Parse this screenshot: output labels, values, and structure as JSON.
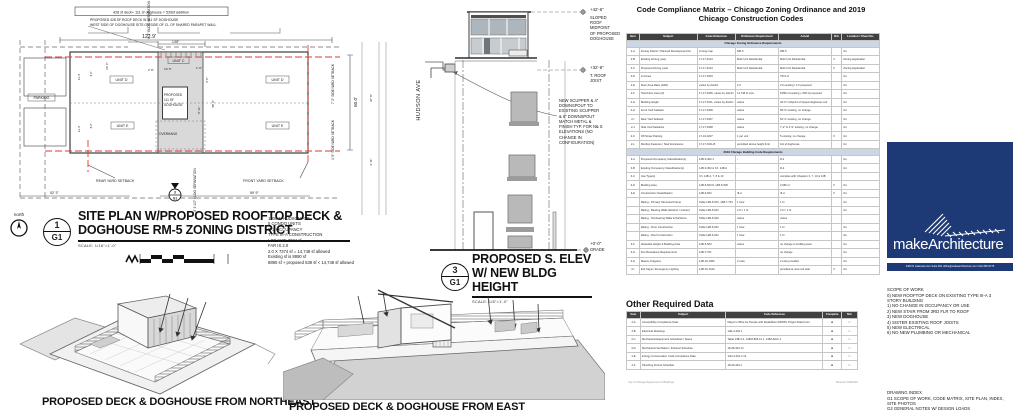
{
  "sheet": {
    "footer_left": "City of Chicago Department of Buildings",
    "footer_right": "Revised 7/09/2020"
  },
  "site_plan": {
    "boxed_note": "428 sf deck+ 111 sf doghouse = 539sf addition",
    "note1": "PROPOSED 428 SF ROOF DECK W 111 SF DOGHOUSE",
    "note2": "WEST SIDE OF DOGHOUSE SITS ON SIDE OF CL OF SHARED PARAPET WALL",
    "parking": "PARKING",
    "unit_c": "UNIT C",
    "unit_d_l": "UNIT D",
    "unit_e_l": "UNIT E",
    "unit_d_r": "UNIT D",
    "unit_e_r": "UNIT E",
    "dog1": "PROPOSED",
    "dog2": "111 SF",
    "dog3": "DOGHOUSE",
    "overhang": "OVERHANG",
    "rear": "REAR YARD SETBACK",
    "front": "FRONT YARD SETBACK",
    "sep_top": "6' 7\" BLDG SEPARATION",
    "sep_bot": "8' 9 1/2\" BLDG SEPARATION",
    "side_top": "7' 2\" SIDEYARD SETBACK",
    "side_bot": "4' 9\" SIDEYARD SETBACK",
    "street": "HUDSON AVE",
    "north": "north",
    "d_width": "122.9'",
    "d_148": "14'8\"",
    "d_523": "52' 3\"",
    "d_599": "59' 9\"",
    "d_600": "60.0'",
    "d_114a": "11.4'",
    "d_32a": "3.2'",
    "d_200": "20' 0\"",
    "d_114b": "11.4'",
    "d_32b": "3.2'",
    "d_26": "2' 6\"",
    "d_105": "10' 5\"",
    "d_16": "1' 6\"",
    "d_40": "4' 0\"",
    "d_359": "35' 9\"",
    "d_811": "8' 11\"",
    "d_378": "37' 8\"",
    "d_411": "4' 11\"",
    "marker_num": "1",
    "marker_sheet": "G1",
    "sec_num": "3",
    "sec_sheet": "G1",
    "title1": "SITE PLAN W/PROPOSED ROOFTOP DECK &",
    "title2": "DOGHOUSE RM-5 ZONING DISTRICT",
    "scale": "SCALE: 1/16\"=1'-0\"",
    "notes": [
      "1906 N HUDSON AVE",
      "5 CONDO UNITS",
      "R-2 OCCUPANCY",
      "TYPE III-A CONSTRUCTION",
      "LOT SIZE 7374 sf",
      "FAR IS 2.0",
      "2.0 X 7374 sf = 14,748 sf allowed",
      "Existing sf is 8890 sf",
      "8890 sf + proposed 539 sf <  14,748 sf allowed"
    ]
  },
  "elevation": {
    "el_top": "+42'-6\"",
    "top_lines": [
      "SLOPED",
      "ROOF",
      "MIDPOINT",
      "OF PROPOSED",
      "DOGHOUSE"
    ],
    "el_mid": "+32'-6\"",
    "mid_lines": [
      "T. ROOF",
      "JOIST"
    ],
    "el_grade": "+0'-0\"",
    "grade_label": "GRADE",
    "note_lines": [
      "NEW SCUPPER & 4\"",
      "DOWNSPOUT TO",
      "EXISTING SCUPPER",
      "& 6\" DOWNSPOUT",
      "MATCH METAL &",
      "FINISH TYP. FOR N& S",
      "ELEVATIONS (NO",
      "CHANGE IN",
      "CONFIGURATION)"
    ],
    "title1": "PROPOSED S. ELEV",
    "title2": "W/ NEW BLDG HEIGHT",
    "scale": "SCALE: 1/8\"=1'-0\"",
    "marker_num": "3",
    "marker_sheet": "G1"
  },
  "renders": {
    "caption_ne": "PROPOSED DECK & DOGHOUSE FROM NORTHEAST",
    "caption_e": "PROPOSED DECK & DOGHOUSE FROM EAST"
  },
  "matrix": {
    "title1": "Code Compliance Matrix – Chicago Zoning Ordinance and 2019",
    "title2": "Chicago Construction Codes",
    "headers": [
      "Item",
      "Subject",
      "Code Reference",
      "Ordinance Requirement",
      "Actual",
      "N/A",
      "Location / Sheet No."
    ],
    "rows": [
      {
        "s": "Chicago Zoning Ordinance Requirements"
      },
      {
        "c": [
          "2-A",
          "Zoning District / Planned Development No.",
          "zoning map",
          "RM-5",
          "RM-5",
          "",
          "G1"
        ]
      },
      {
        "c": [
          "2-B",
          "Existing Zoning (use)",
          "17-17-0104",
          "Multi Unit Residential",
          "Multi Unit Residential",
          "X",
          "Zoning Application"
        ]
      },
      {
        "c": [
          "2-C",
          "Proposed Zoning (use)",
          "17-17-0104",
          "Multi Unit Residential",
          "Multi Unit Residential",
          "X",
          "Zoning Application"
        ]
      },
      {
        "c": [
          "2-D",
          "Lot Area",
          "17-17-0303",
          "",
          "7374 sf",
          "",
          "G1"
        ]
      },
      {
        "c": [
          "2-E",
          "Floor Area Ratio (FAR)",
          "varies by district",
          "2.0",
          "2.0 existing / 2.0 proposed",
          "",
          "G1"
        ]
      },
      {
        "c": [
          "2-F",
          "Total Floor Area (sf)",
          "17-17-0305, varies by district",
          "14,748 sf max",
          "8,890 sf existing + 539 sf proposed",
          "",
          "G1"
        ]
      },
      {
        "c": [
          "2-G",
          "Building Height",
          "17-17-0311, varies by district",
          "varies",
          "42'-6\" midpoint of sloped doghouse roof",
          "",
          "G1"
        ]
      },
      {
        "c": [
          "2-H",
          "Front Yard Setback",
          "17-17-0306",
          "varies",
          "59'-9\" existing, no change",
          "",
          "G1"
        ]
      },
      {
        "c": [
          "2-I",
          "Rear Yard Setback",
          "17-17-0307",
          "varies",
          "52'-3\" existing, no change",
          "",
          "G1"
        ]
      },
      {
        "c": [
          "2-J",
          "Side Yard Setbacks",
          "17-17-0308",
          "varies",
          "7'-2\" & 4'-9\" existing, no change",
          "",
          "G1"
        ]
      },
      {
        "c": [
          "2-K",
          "Off-Street Parking",
          "17-10-0207",
          "1 per unit",
          "5 existing, no change",
          "X",
          "G1"
        ]
      },
      {
        "c": [
          "2-L",
          "Rooftop Features / Stair Enclosures",
          "17-17-0311-B",
          "permitted above height limit",
          "111 sf doghouse",
          "",
          "G1"
        ]
      },
      {
        "s": "2019 Chicago Building Code Requirements"
      },
      {
        "c": [
          "3-A",
          "Proposed Occupancy Classification(s)",
          "14B-3-302.1",
          "-",
          "R-2",
          "",
          "G1"
        ]
      },
      {
        "c": [
          "3-B",
          "Existing Occupancy Classification(s)",
          "14B-3-302 & Ch. 14B-3",
          "-",
          "R-2",
          "",
          "G1"
        ]
      },
      {
        "c": [
          "3-C",
          "Use Type(s)",
          "Ch. 14B-2, 7, 8 & 10",
          "",
          "complies with Chapters 3, 7, 10 & 14B",
          "",
          ""
        ]
      },
      {
        "c": [
          "3-D",
          "Building Area",
          "14B-5-503.8, 14B-5-506",
          "",
          "2,966 sf",
          "X",
          "G1"
        ]
      },
      {
        "c": [
          "3-E",
          "Construction Classification",
          "14B-6-602",
          "III-A",
          "III-A",
          "X",
          "G1"
        ]
      },
      {
        "c": [
          "",
          "Rating - Primary Structural Frame",
          "Table 14B-6-601, 14B-7-704",
          "1 hour",
          "1 hr",
          "",
          "G1"
        ]
      },
      {
        "c": [
          "",
          "Rating - Bearing Walls (Exterior / Interior)",
          "Table 14B-6-601",
          "2 hr / 1 hr",
          "2 hr / 1 hr",
          "",
          "G1"
        ]
      },
      {
        "c": [
          "",
          "Rating - Nonbearing Walls & Partitions",
          "Table 14B-6-602",
          "varies",
          "varies",
          "",
          ""
        ]
      },
      {
        "c": [
          "",
          "Rating - Floor Construction",
          "Table 14B-6-601",
          "1 hour",
          "1 hr",
          "",
          "G1"
        ]
      },
      {
        "c": [
          "",
          "Rating - Roof Construction",
          "Table 14B-6-601",
          "1 hour",
          "1 hr",
          "",
          "G1"
        ]
      },
      {
        "c": [
          "3-F",
          "Allowable Height & Building Area",
          "14B-5-503",
          "varies",
          "no change to building area",
          "",
          "G1"
        ]
      },
      {
        "c": [
          "3-G",
          "Fire Resistance Requirements",
          "14B-7-701",
          "",
          "no change",
          "",
          "G1"
        ]
      },
      {
        "c": [
          "3-H",
          "Means of Egress",
          "14B-10-1006",
          "2 exits",
          "2 exits provided",
          "",
          "G1"
        ]
      },
      {
        "c": [
          "3-I",
          "Exit Signs / Emergency Lighting",
          "14B-10-1013",
          "",
          "provided at new roof stair",
          "X",
          "G1"
        ]
      }
    ],
    "other_title": "Other Required Data",
    "other_headers": [
      "Item",
      "Subject",
      "Code Reference",
      "Complete",
      "N/A"
    ],
    "other_rows": [
      {
        "c": [
          "4-A",
          "Accessibility Compliance Data",
          "Mayor's Office for People with Disabilities (MOPD) Project Data Form",
          "■",
          "□"
        ]
      },
      {
        "c": [
          "4-B",
          "Electrical Drawings",
          "14E-2-202.1",
          "■",
          "□"
        ]
      },
      {
        "c": [
          "4-C",
          "Mechanical Equipment Schedules / Specs",
          "Table 14B-4-2, 14B-8-806.12.1, 14B-HVAC-1",
          "■",
          "□"
        ]
      },
      {
        "c": [
          "4-D",
          "Mechanical Ventilation / Exhaust Schedule",
          "18-28-403.14",
          "■",
          "□"
        ]
      },
      {
        "c": [
          "4-E",
          "Energy Conservation Code Compliance Data",
          "14N-4-401.2.12",
          "■",
          "□"
        ]
      },
      {
        "c": [
          "4-F",
          "Plumbing Fixture Schedule",
          "18-29-403.1",
          "■",
          "□"
        ]
      }
    ]
  },
  "brand": {
    "logo_text": "makeArchitecture",
    "address": "2400 N Lakeview Ave Suite 601   office@makearchitecture.com   312-450-6775",
    "accent_color": "#1e3a76",
    "scope_title": "SCOPE OF WORK",
    "scope_lines": [
      "0) NEW ROOFTOP DECK ON EXISTING TYPE III-A 3",
      "STORY BUILDING",
      "1) NO CHANGE IN OCCUPANCY OR USE",
      "2) NEW STAIR FROM 3RD FLR TO ROOF",
      "3) NEW DOGHOUSE",
      "4) SISTER EXISTING ROOF JOISTS",
      "5) NEW ELECTRICAL",
      "6) NO NEW PLUMBING OR MECHANICAL"
    ],
    "index_title": "DRAWING INDEX",
    "index_lines": [
      "G1 SCOPE OF WORK, CODE MATRIX, SITE PLAN, INDEX,",
      "SITE PHOTOS",
      "G2 GENERAL NOTES W/ DESIGN LOADS"
    ]
  }
}
